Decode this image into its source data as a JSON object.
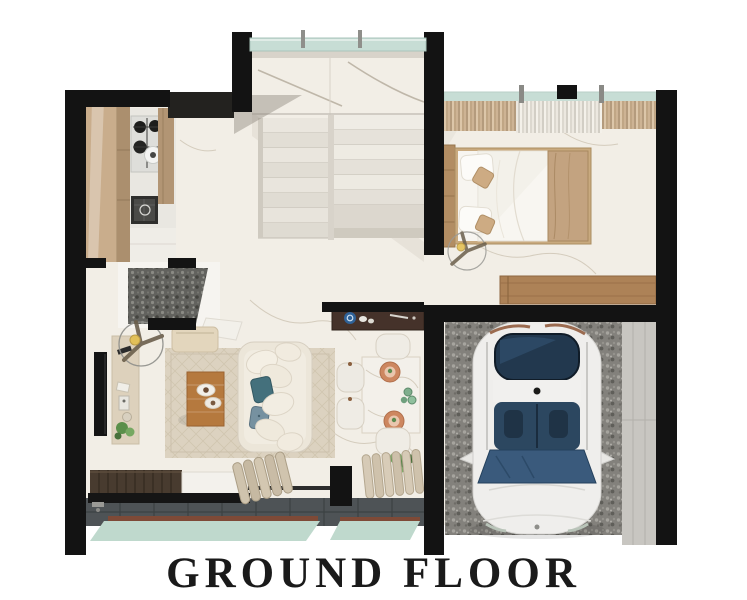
{
  "title": {
    "label": "GROUND FLOOR"
  },
  "plan": {
    "type": "architectural-floor-plan-render",
    "view": "top-down",
    "areas": [
      "kitchen",
      "staircase",
      "bedroom",
      "powder-room",
      "hall",
      "living-room",
      "dining-area",
      "garage",
      "terrace"
    ],
    "objects": [
      "stove",
      "sink",
      "kitchen-cabinets",
      "stairs",
      "glass-railing",
      "double-bed",
      "pillows",
      "curtains",
      "ceiling-fan",
      "wood-bench",
      "sideboard",
      "dining-table",
      "dining-chairs",
      "plates",
      "potted-plant",
      "sofa",
      "coffee-table",
      "tv",
      "media-console",
      "area-rug",
      "lounge-bench",
      "rolled-blinds",
      "wood-deck",
      "pool-edge",
      "car"
    ]
  },
  "colors": {
    "bg": "#ffffff",
    "wall": "#131313",
    "marble": "#f2eee6",
    "veinc": "#cfc5b5",
    "glass": "#c7ddd5",
    "cabinet": "#c9ad8c",
    "wood": "#b5793e",
    "rug": "#dcd2c0",
    "sofa": "#ece6d9",
    "tile": "#4e5356",
    "pool": "#bfd9cd",
    "pebble": "#83817c",
    "carbody": "#efeeec",
    "carglass": "#2c4760",
    "throw": "#c3a380",
    "sideboard": "#45322a",
    "concrete": "#c8c6c1",
    "plate": "#cd8760",
    "plant": "#5a8f4a",
    "title": "#1a1a1a"
  }
}
